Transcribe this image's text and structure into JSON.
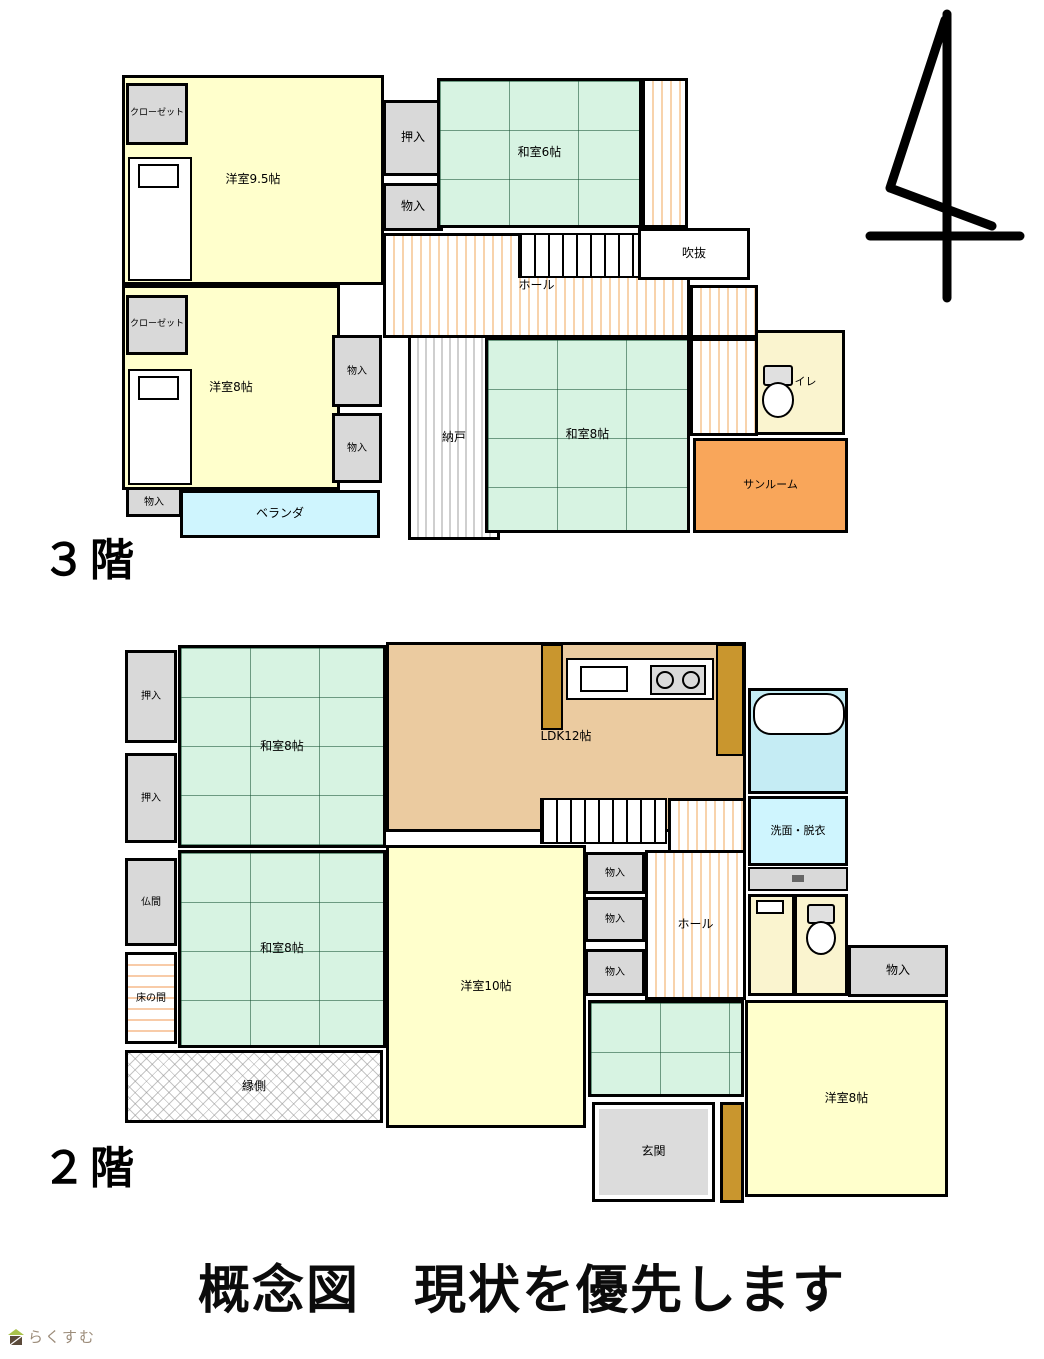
{
  "page": {
    "title_text": "概念図　現状を優先します",
    "logo_text": "らくすむ"
  },
  "colors": {
    "western_room": "#FFFFCC",
    "tatami_room": "#D7F3E2",
    "storage_gray": "#D9D9D9",
    "ldk_tan": "#EBCBA0",
    "sunroom_orange": "#F9A65A",
    "veranda_blue": "#CFF5FE",
    "bath_blue": "#C5ECF4",
    "toilet_yellow": "#FAF4CF",
    "cabinet_brown": "#C9962E",
    "wall": "#000000"
  },
  "floors": [
    {
      "id": "floor3",
      "label": "３階",
      "origin": {
        "left": 120,
        "top": 73
      },
      "size": {
        "w": 732,
        "h": 472
      },
      "rooms": [
        {
          "name": "room-yoshitsu-9-5",
          "label": "洋室9.5帖",
          "x": 2,
          "y": 2,
          "w": 262,
          "h": 210,
          "cls": "cream"
        },
        {
          "name": "closet-nw-upper",
          "label": "クローゼット",
          "x": 6,
          "y": 10,
          "w": 62,
          "h": 62,
          "cls": "gray",
          "fs": 9
        },
        {
          "name": "room-yoshitsu-8-3f",
          "label": "洋室8帖",
          "x": 2,
          "y": 212,
          "w": 218,
          "h": 205,
          "cls": "cream"
        },
        {
          "name": "closet-nw-lower",
          "label": "クローゼット",
          "x": 6,
          "y": 222,
          "w": 62,
          "h": 60,
          "cls": "gray",
          "fs": 9
        },
        {
          "name": "monoire-3f-sw",
          "label": "物入",
          "x": 6,
          "y": 414,
          "w": 56,
          "h": 30,
          "cls": "gray",
          "fs": 10
        },
        {
          "name": "veranda",
          "label": "ベランダ",
          "x": 60,
          "y": 417,
          "w": 200,
          "h": 48,
          "cls": "lblue"
        },
        {
          "name": "oshiire-3f",
          "label": "押入",
          "x": 263,
          "y": 27,
          "w": 60,
          "h": 76,
          "cls": "gray"
        },
        {
          "name": "monoire-3f-n",
          "label": "物入",
          "x": 263,
          "y": 110,
          "w": 60,
          "h": 48,
          "cls": "gray"
        },
        {
          "name": "room-washitsu-6",
          "label": "和室6帖",
          "x": 317,
          "y": 5,
          "w": 205,
          "h": 150,
          "cls": "tatami"
        },
        {
          "name": "corridor-east-strip",
          "x": 522,
          "y": 5,
          "w": 46,
          "h": 150,
          "cls": "hallstripe"
        },
        {
          "name": "hall-3f-main",
          "label": "ホール",
          "x": 263,
          "y": 160,
          "w": 307,
          "h": 105,
          "cls": "hallstripe"
        },
        {
          "name": "hall-3f-link",
          "x": 570,
          "y": 212,
          "w": 68,
          "h": 53,
          "cls": "hallstripe"
        },
        {
          "name": "hall-3f-arm",
          "x": 570,
          "y": 265,
          "w": 68,
          "h": 98,
          "cls": "hallstripe"
        },
        {
          "name": "fukinuke",
          "label": "吹抜",
          "x": 518,
          "y": 155,
          "w": 112,
          "h": 52,
          "cls": "white"
        },
        {
          "name": "monoire-3f-mid-upper",
          "label": "物入",
          "x": 212,
          "y": 262,
          "w": 50,
          "h": 72,
          "cls": "gray",
          "fs": 10
        },
        {
          "name": "monoire-3f-mid-lower",
          "label": "物入",
          "x": 212,
          "y": 340,
          "w": 50,
          "h": 70,
          "cls": "gray",
          "fs": 10
        },
        {
          "name": "nando",
          "label": "納戸",
          "x": 288,
          "y": 262,
          "w": 92,
          "h": 205,
          "cls": "nandostripe"
        },
        {
          "name": "room-washitsu-8-3f",
          "label": "和室8帖",
          "x": 365,
          "y": 264,
          "w": 205,
          "h": 196,
          "cls": "tatami"
        },
        {
          "name": "toilet-3f",
          "label": "トイレ",
          "x": 635,
          "y": 257,
          "w": 90,
          "h": 105,
          "cls": "tyellow",
          "fs": 11
        },
        {
          "name": "sunroom",
          "label": "サンルーム",
          "x": 573,
          "y": 365,
          "w": 155,
          "h": 95,
          "cls": "orange",
          "fs": 11
        }
      ],
      "fixtures": [
        {
          "name": "bed-upper",
          "type": "bed",
          "x": 8,
          "y": 84,
          "w": 64,
          "h": 124
        },
        {
          "name": "bed-lower",
          "type": "bed",
          "x": 8,
          "y": 296,
          "w": 64,
          "h": 116
        },
        {
          "name": "stairs-3f",
          "type": "stairs",
          "x": 398,
          "y": 160,
          "w": 122,
          "h": 45
        },
        {
          "name": "toilet-bowl-3f",
          "type": "toilet",
          "x": 640,
          "y": 292,
          "w": 36,
          "h": 54
        }
      ]
    },
    {
      "id": "floor2",
      "label": "２階",
      "origin": {
        "left": 122,
        "top": 640
      },
      "size": {
        "w": 830,
        "h": 570
      },
      "rooms": [
        {
          "name": "oshiire-2f-upper",
          "label": "押入",
          "x": 3,
          "y": 10,
          "w": 52,
          "h": 93,
          "cls": "gray",
          "fs": 10
        },
        {
          "name": "oshiire-2f-lower",
          "label": "押入",
          "x": 3,
          "y": 113,
          "w": 52,
          "h": 90,
          "cls": "gray",
          "fs": 10
        },
        {
          "name": "room-washitsu-8-2f-n",
          "label": "和室8帖",
          "x": 56,
          "y": 5,
          "w": 208,
          "h": 203,
          "cls": "tatami"
        },
        {
          "name": "room-ldk",
          "label": "LDK12帖",
          "x": 264,
          "y": 2,
          "w": 360,
          "h": 190,
          "cls": "tan"
        },
        {
          "name": "bath",
          "x": 626,
          "y": 48,
          "w": 100,
          "h": 106,
          "cls": "bathblue"
        },
        {
          "name": "senmen-datsui",
          "label": "洗面・脱衣",
          "x": 626,
          "y": 156,
          "w": 100,
          "h": 70,
          "cls": "lblue",
          "fs": 11
        },
        {
          "name": "toilet-2f",
          "x": 626,
          "y": 254,
          "w": 100,
          "h": 102,
          "cls": "tyellow"
        },
        {
          "name": "monoire-2f-a",
          "label": "物入",
          "x": 463,
          "y": 212,
          "w": 60,
          "h": 42,
          "cls": "gray",
          "fs": 10
        },
        {
          "name": "monoire-2f-b",
          "label": "物入",
          "x": 463,
          "y": 257,
          "w": 60,
          "h": 45,
          "cls": "gray",
          "fs": 10
        },
        {
          "name": "monoire-2f-c",
          "label": "物入",
          "x": 463,
          "y": 309,
          "w": 60,
          "h": 47,
          "cls": "gray",
          "fs": 10
        },
        {
          "name": "hall-2f-upper",
          "x": 546,
          "y": 158,
          "w": 78,
          "h": 55,
          "cls": "hallstripe"
        },
        {
          "name": "hall-2f-main",
          "label": "ホール",
          "x": 523,
          "y": 210,
          "w": 101,
          "h": 150,
          "cls": "hallstripe"
        },
        {
          "name": "butsuma",
          "label": "仏間",
          "x": 3,
          "y": 218,
          "w": 52,
          "h": 88,
          "cls": "gray",
          "fs": 10
        },
        {
          "name": "tokonoma",
          "label": "床の間",
          "x": 3,
          "y": 312,
          "w": 52,
          "h": 92,
          "cls": "tokostripe",
          "fs": 10
        },
        {
          "name": "room-washitsu-8-2f-s",
          "label": "和室8帖",
          "x": 56,
          "y": 210,
          "w": 208,
          "h": 198,
          "cls": "tatami"
        },
        {
          "name": "engawa",
          "label": "縁側",
          "x": 3,
          "y": 410,
          "w": 258,
          "h": 73,
          "cls": "crosshatch"
        },
        {
          "name": "room-yoshitsu-10",
          "label": "洋室10帖",
          "x": 264,
          "y": 205,
          "w": 200,
          "h": 283,
          "cls": "cream"
        },
        {
          "name": "tatami-passage",
          "x": 466,
          "y": 360,
          "w": 156,
          "h": 97,
          "cls": "tatami"
        },
        {
          "name": "genkan",
          "label": "玄関",
          "x": 470,
          "y": 462,
          "w": 123,
          "h": 100,
          "cls": "genkan"
        },
        {
          "name": "shoe-cabinet",
          "x": 598,
          "y": 462,
          "w": 24,
          "h": 101,
          "cls": "brown"
        },
        {
          "name": "monoire-2f-se",
          "label": "物入",
          "x": 726,
          "y": 305,
          "w": 100,
          "h": 52,
          "cls": "gray"
        },
        {
          "name": "room-yoshitsu-8-2f",
          "label": "洋室8帖",
          "x": 623,
          "y": 360,
          "w": 203,
          "h": 197,
          "cls": "cream"
        }
      ],
      "fixtures": [
        {
          "name": "kitchen-counter",
          "type": "counter",
          "x": 444,
          "y": 18,
          "w": 148,
          "h": 42
        },
        {
          "name": "kitchen-sink",
          "type": "sink",
          "x": 458,
          "y": 26,
          "w": 48,
          "h": 26
        },
        {
          "name": "kitchen-stove",
          "type": "stove",
          "x": 528,
          "y": 25,
          "w": 56,
          "h": 30
        },
        {
          "name": "kitchen-cab-left",
          "type": "cab",
          "x": 419,
          "y": 4,
          "w": 22,
          "h": 86
        },
        {
          "name": "kitchen-cab-right",
          "type": "cab",
          "x": 594,
          "y": 4,
          "w": 28,
          "h": 112
        },
        {
          "name": "bathtub",
          "type": "tub",
          "x": 631,
          "y": 53,
          "w": 92,
          "h": 42
        },
        {
          "name": "stairs-2f",
          "type": "stairs",
          "x": 418,
          "y": 158,
          "w": 127,
          "h": 46
        },
        {
          "name": "vanity",
          "type": "vanity",
          "x": 626,
          "y": 227,
          "w": 100,
          "h": 24
        },
        {
          "name": "wc-divider",
          "type": "wall",
          "x": 670,
          "y": 256,
          "w": 5,
          "h": 98
        },
        {
          "name": "wc-hand-sink",
          "type": "wc-sink",
          "x": 634,
          "y": 260,
          "w": 28,
          "h": 14
        },
        {
          "name": "toilet-bowl-2f",
          "type": "toilet",
          "x": 682,
          "y": 264,
          "w": 34,
          "h": 52
        }
      ]
    }
  ]
}
